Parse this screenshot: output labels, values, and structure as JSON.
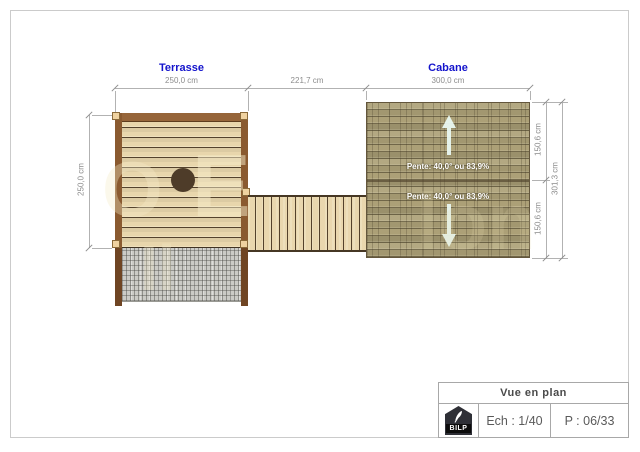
{
  "labels": {
    "terrasse": "Terrasse",
    "cabane": "Cabane"
  },
  "dims": {
    "terrasse_width": "250,0 cm",
    "gap_width": "221,7 cm",
    "cabane_width": "300,0 cm",
    "terrasse_depth": "250,0 cm",
    "cabane_top_half": "150,6 cm",
    "cabane_bottom_half": "150,6 cm",
    "cabane_total_depth": "301,3 cm"
  },
  "roof": {
    "slope_top": "Pente: 40,0° ou 83,9%",
    "slope_bottom": "Pente: 40,0° ou 83,9%"
  },
  "watermark": {
    "f1": "O",
    "f2": "E",
    "f3": "Il",
    "f4": "lon"
  },
  "titleblock": {
    "title": "Vue en plan",
    "scale": "Ech : 1/40",
    "page": "P : 06/33",
    "logo": "BILP"
  },
  "colors": {
    "accent_blue": "#1414cc",
    "deck_wood": "#e8d6ac",
    "frame_wood": "#8a5a30",
    "post_wood": "#6f4523",
    "shingle": "#aca077",
    "mesh_gray": "#cbcbc6",
    "dim_gray": "#8c8c8c",
    "arrow_white": "#e9f8f1"
  }
}
